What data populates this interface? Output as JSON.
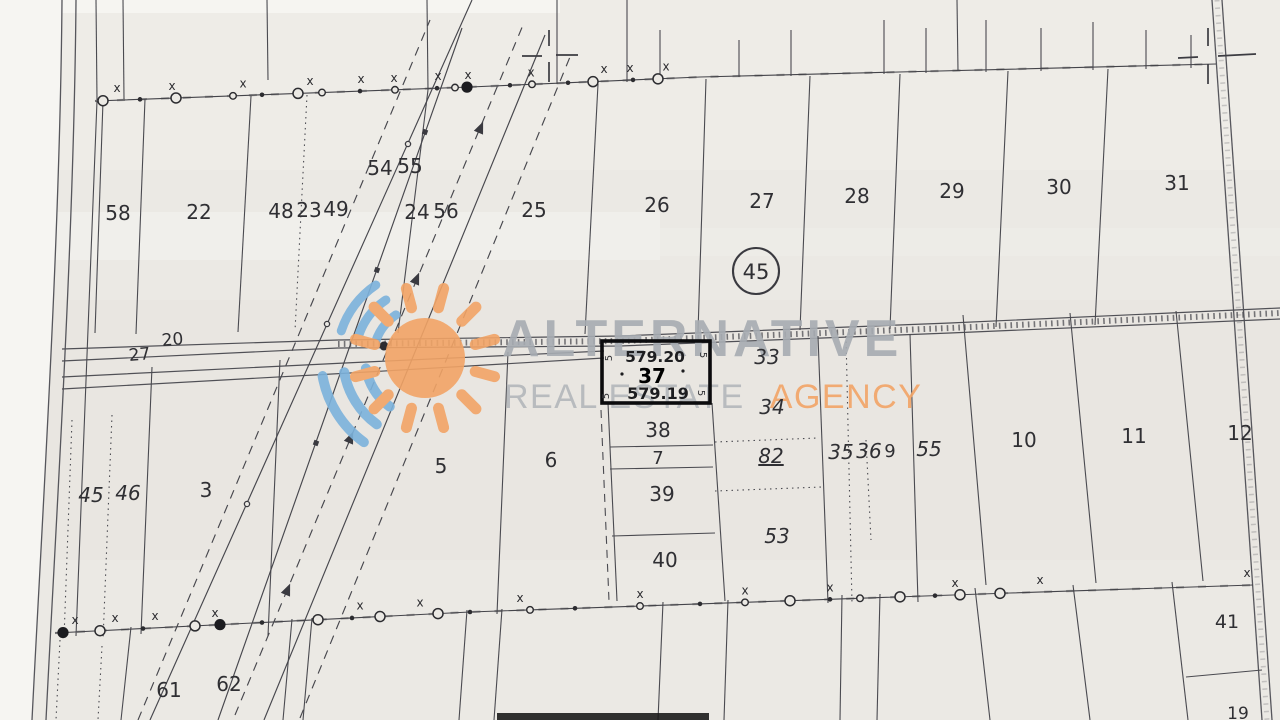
{
  "colors": {
    "paper": "#ebe9e4",
    "paper_light": "#f6f5f2",
    "ink": "#44444a",
    "label_ink": "#2f2f33",
    "bold_ink": "#0b0b0d",
    "watermark_gray": "#a7acb2",
    "watermark_orange": "#f2a466",
    "watermark_blue": "#7cb2dc"
  },
  "watermark": {
    "line1": "ALTERNATIVE",
    "line2_gray": "REAL ESTATE",
    "line2_orange": "AGENCY",
    "logo": "sun-with-signal-arcs"
  },
  "highlighted_plot": {
    "number": "37",
    "elevation_top": "579.20",
    "elevation_bottom": "579.19"
  },
  "region_circle": {
    "number": "45"
  },
  "road_labels": [
    {
      "t": "20",
      "x": 173,
      "y": 345,
      "s": 17,
      "r": -5
    },
    {
      "t": "27",
      "x": 140,
      "y": 360,
      "s": 17,
      "r": -5
    }
  ],
  "labels": [
    {
      "t": "58",
      "x": 118,
      "y": 220
    },
    {
      "t": "22",
      "x": 199,
      "y": 219
    },
    {
      "t": "48",
      "x": 281,
      "y": 218
    },
    {
      "t": "23",
      "x": 309,
      "y": 217
    },
    {
      "t": "49",
      "x": 336,
      "y": 216
    },
    {
      "t": "54",
      "x": 380,
      "y": 175
    },
    {
      "t": "55",
      "x": 410,
      "y": 173
    },
    {
      "t": "24",
      "x": 417,
      "y": 219
    },
    {
      "t": "56",
      "x": 446,
      "y": 218
    },
    {
      "t": "25",
      "x": 534,
      "y": 217
    },
    {
      "t": "26",
      "x": 657,
      "y": 212
    },
    {
      "t": "27",
      "x": 762,
      "y": 208
    },
    {
      "t": "28",
      "x": 857,
      "y": 203
    },
    {
      "t": "29",
      "x": 952,
      "y": 198
    },
    {
      "t": "30",
      "x": 1059,
      "y": 194
    },
    {
      "t": "31",
      "x": 1177,
      "y": 190
    },
    {
      "t": "33",
      "x": 767,
      "y": 364,
      "i": 1
    },
    {
      "t": "34",
      "x": 772,
      "y": 414,
      "i": 1
    },
    {
      "t": "82",
      "x": 771,
      "y": 463,
      "i": 1,
      "u": 1
    },
    {
      "t": "35",
      "x": 841,
      "y": 459,
      "i": 1
    },
    {
      "t": "36",
      "x": 869,
      "y": 458,
      "i": 1
    },
    {
      "t": "9",
      "x": 890,
      "y": 457,
      "s": 18
    },
    {
      "t": "55",
      "x": 929,
      "y": 456,
      "i": 1
    },
    {
      "t": "53",
      "x": 777,
      "y": 543,
      "i": 1
    },
    {
      "t": "38",
      "x": 658,
      "y": 437
    },
    {
      "t": "7",
      "x": 658,
      "y": 464,
      "s": 18
    },
    {
      "t": "39",
      "x": 662,
      "y": 501
    },
    {
      "t": "40",
      "x": 665,
      "y": 567
    },
    {
      "t": "5",
      "x": 441,
      "y": 473
    },
    {
      "t": "6",
      "x": 551,
      "y": 467
    },
    {
      "t": "3",
      "x": 206,
      "y": 497
    },
    {
      "t": "45",
      "x": 91,
      "y": 502,
      "i": 1
    },
    {
      "t": "46",
      "x": 128,
      "y": 500,
      "i": 1
    },
    {
      "t": "10",
      "x": 1024,
      "y": 447
    },
    {
      "t": "11",
      "x": 1134,
      "y": 443
    },
    {
      "t": "12",
      "x": 1240,
      "y": 440
    },
    {
      "t": "41",
      "x": 1227,
      "y": 628,
      "s": 19
    },
    {
      "t": "61",
      "x": 169,
      "y": 697
    },
    {
      "t": "62",
      "x": 229,
      "y": 691
    },
    {
      "t": "19",
      "x": 1238,
      "y": 719,
      "s": 17
    },
    {
      "t": "5",
      "x": 612,
      "y": 358,
      "s": 10,
      "r": -90
    },
    {
      "t": "5",
      "x": 609,
      "y": 396,
      "s": 10,
      "r": -90
    },
    {
      "t": "5",
      "x": 700,
      "y": 355,
      "s": 10,
      "r": 90
    },
    {
      "t": "5",
      "x": 698,
      "y": 393,
      "s": 10,
      "r": 90
    }
  ],
  "survey": {
    "top_line": [
      [
        95,
        101
      ],
      [
        470,
        87
      ],
      [
        700,
        77
      ],
      [
        1216,
        64
      ]
    ],
    "bottom_line": [
      [
        55,
        633
      ],
      [
        470,
        612
      ],
      [
        1010,
        593
      ],
      [
        1253,
        585
      ]
    ],
    "top_markers": [
      [
        103,
        1
      ],
      [
        140,
        0
      ],
      [
        176,
        1
      ],
      [
        233,
        2
      ],
      [
        262,
        0
      ],
      [
        298,
        1
      ],
      [
        322,
        2
      ],
      [
        360,
        0
      ],
      [
        395,
        2
      ],
      [
        437,
        0
      ],
      [
        455,
        2
      ],
      [
        467,
        3
      ],
      [
        510,
        0
      ],
      [
        532,
        2
      ],
      [
        568,
        0
      ],
      [
        593,
        1
      ],
      [
        633,
        0
      ],
      [
        658,
        1
      ]
    ],
    "top_xmarks": [
      117,
      172,
      243,
      310,
      361,
      394,
      438,
      468,
      531,
      604,
      630,
      666
    ],
    "bottom_markers": [
      [
        63,
        3
      ],
      [
        100,
        1
      ],
      [
        143,
        0
      ],
      [
        195,
        1
      ],
      [
        220,
        3
      ],
      [
        262,
        0
      ],
      [
        318,
        1
      ],
      [
        352,
        0
      ],
      [
        380,
        1
      ],
      [
        438,
        1
      ],
      [
        470,
        0
      ],
      [
        530,
        2
      ],
      [
        575,
        0
      ],
      [
        640,
        2
      ],
      [
        700,
        0
      ],
      [
        745,
        2
      ],
      [
        790,
        1
      ],
      [
        830,
        0
      ],
      [
        860,
        2
      ],
      [
        900,
        1
      ],
      [
        935,
        0
      ],
      [
        960,
        1
      ],
      [
        1000,
        1
      ]
    ],
    "bottom_xmarks": [
      75,
      115,
      155,
      215,
      360,
      420,
      520,
      640,
      745,
      830,
      955,
      1040,
      1247
    ]
  }
}
